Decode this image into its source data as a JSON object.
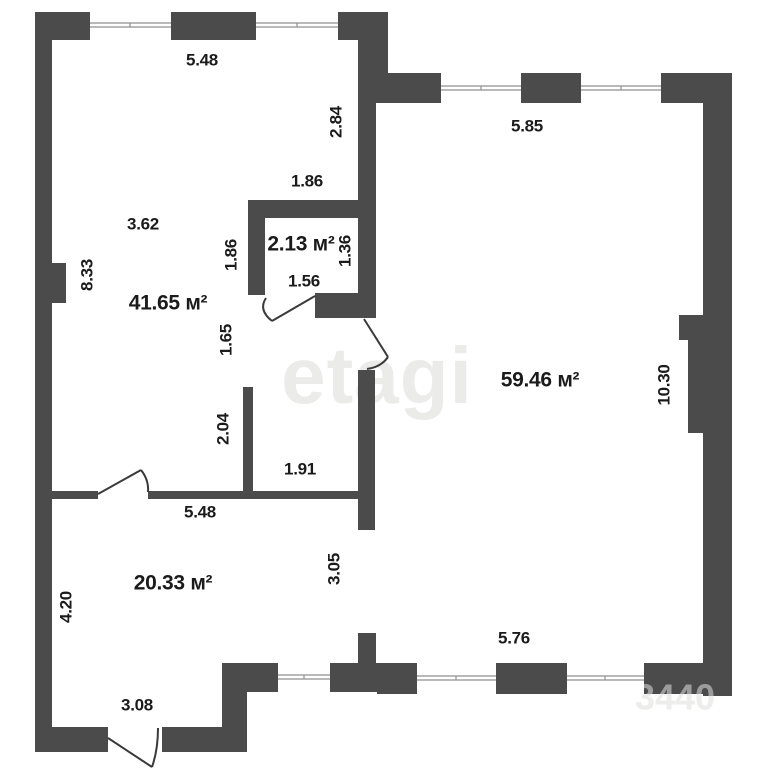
{
  "colors": {
    "wall": "#4b4b4b",
    "door": "#3a3a3a",
    "window_line": "#8f8f8f",
    "label": "#1b1b1b",
    "watermark": "#ebebe9",
    "watermark_corner": "#dededc",
    "background": "#ffffff"
  },
  "watermark": {
    "main": "etagi",
    "corner": "3440"
  },
  "rooms": [
    {
      "id": "room-41-65",
      "label": "41.65 м²",
      "x": 168,
      "y": 304
    },
    {
      "id": "room-2-13",
      "label": "2.13 м²",
      "x": 301,
      "y": 245
    },
    {
      "id": "room-59-46",
      "label": "59.46 м²",
      "x": 540,
      "y": 381
    },
    {
      "id": "room-20-33",
      "label": "20.33 м²",
      "x": 173,
      "y": 584
    }
  ],
  "dimensions": [
    {
      "text": "5.48",
      "x": 202,
      "y": 61,
      "rot": 0
    },
    {
      "text": "2.84",
      "x": 337,
      "y": 122,
      "rot": -90
    },
    {
      "text": "5.85",
      "x": 527,
      "y": 127,
      "rot": 0
    },
    {
      "text": "1.86",
      "x": 307,
      "y": 182,
      "rot": 0
    },
    {
      "text": "3.62",
      "x": 143,
      "y": 225,
      "rot": 0
    },
    {
      "text": "1.86",
      "x": 232,
      "y": 255,
      "rot": -90
    },
    {
      "text": "1.36",
      "x": 346,
      "y": 251,
      "rot": -90
    },
    {
      "text": "8.33",
      "x": 88,
      "y": 275,
      "rot": -90
    },
    {
      "text": "1.56",
      "x": 304,
      "y": 282,
      "rot": 0
    },
    {
      "text": "1.65",
      "x": 227,
      "y": 340,
      "rot": -90
    },
    {
      "text": "10.30",
      "x": 665,
      "y": 385,
      "rot": -90
    },
    {
      "text": "2.04",
      "x": 224,
      "y": 429,
      "rot": -90
    },
    {
      "text": "1.91",
      "x": 300,
      "y": 470,
      "rot": 0
    },
    {
      "text": "5.48",
      "x": 200,
      "y": 513,
      "rot": 0
    },
    {
      "text": "3.05",
      "x": 335,
      "y": 569,
      "rot": -90
    },
    {
      "text": "4.20",
      "x": 67,
      "y": 607,
      "rot": -90
    },
    {
      "text": "5.76",
      "x": 514,
      "y": 639,
      "rot": 0
    },
    {
      "text": "3.08",
      "x": 137,
      "y": 706,
      "rot": 0
    }
  ]
}
